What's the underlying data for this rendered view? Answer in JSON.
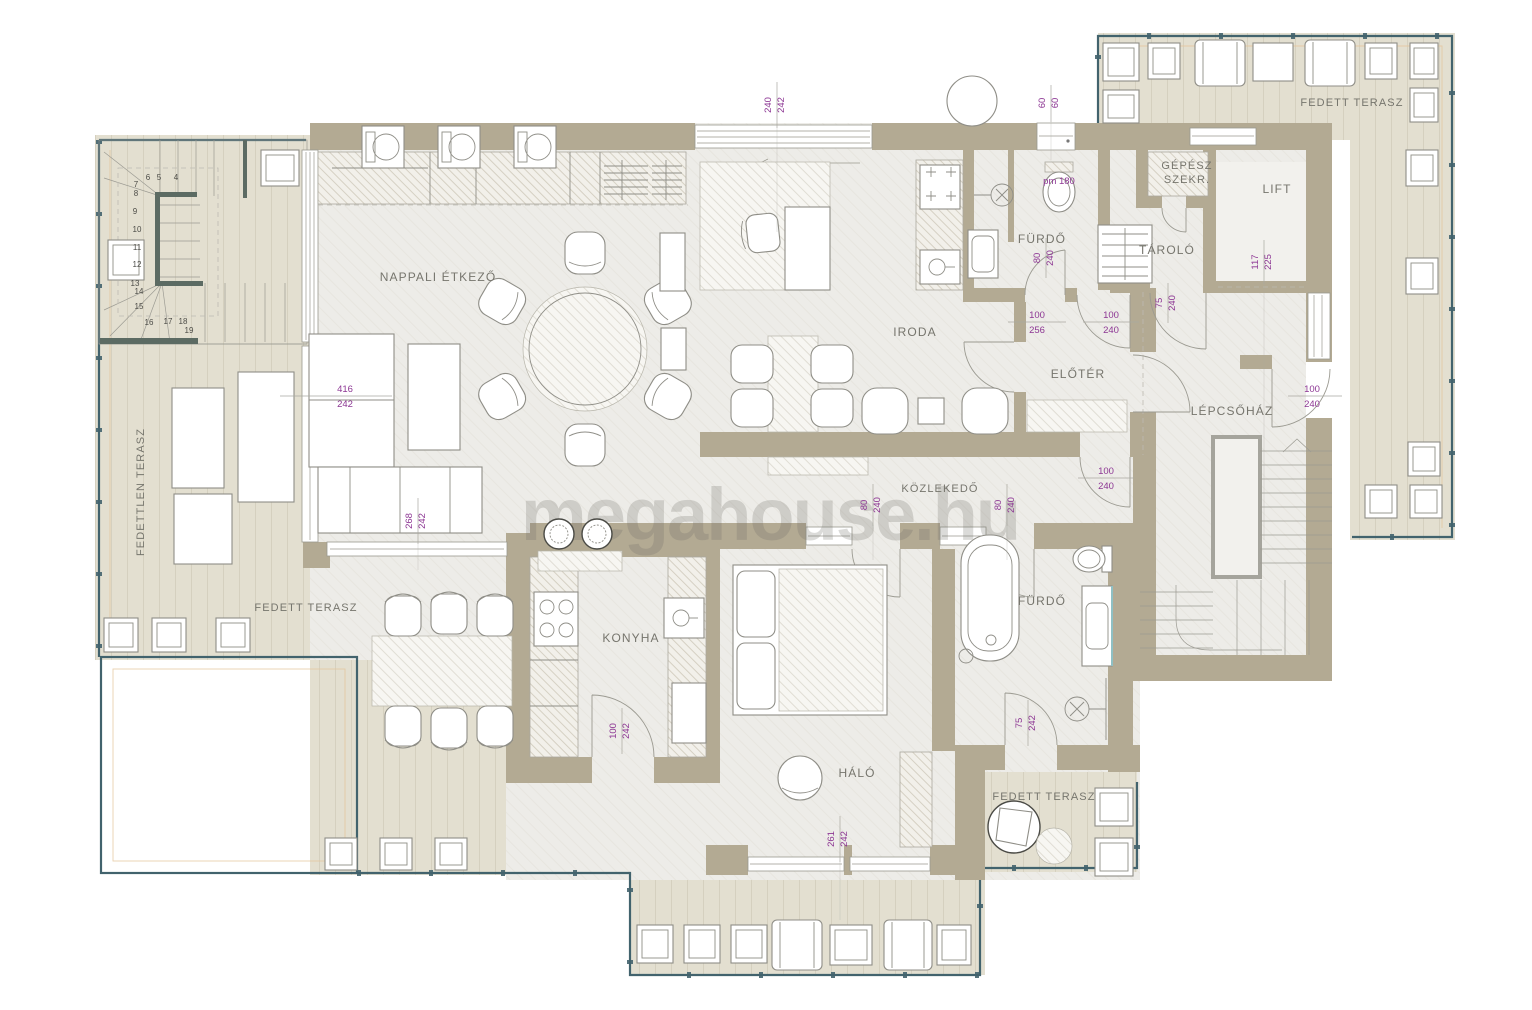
{
  "watermark": "megahouse.hu",
  "rooms": {
    "living": "NAPPALI ÉTKEZŐ",
    "office": "IRODA",
    "bath_top": "FÜRDŐ",
    "storage": "TÁROLÓ",
    "mech_line1": "GÉPÉSZ",
    "mech_line2": "SZEKR.",
    "lift": "LIFT",
    "foyer": "ELŐTÉR",
    "stairwell": "LÉPCSŐHÁZ",
    "corridor": "KÖZLEKEDŐ",
    "kitchen": "KONYHA",
    "bedroom": "HÁLÓ",
    "bath_bottom": "FÜRDŐ",
    "terrace_top_right": "FEDETT TERASZ",
    "terrace_bottom_left": "FEDETT TERASZ",
    "terrace_bottom_right": "FEDETT TERASZ",
    "terrace_left": "FEDETTLEN TERASZ"
  },
  "dims": {
    "top_window": {
      "a": "240",
      "b": "242"
    },
    "top_door": {
      "a": "60",
      "b": "60"
    },
    "wc_label": "pm 180",
    "bath_top_door": {
      "a": "80",
      "b": "240"
    },
    "foyer_left_door": {
      "a": "100",
      "b": "256"
    },
    "foyer_top_door": {
      "a": "100",
      "b": "240"
    },
    "storage_door": {
      "a": "75",
      "b": "240"
    },
    "lift_shaft": {
      "a": "117",
      "b": "225"
    },
    "stair_terrace_door": {
      "a": "100",
      "b": "240"
    },
    "living_window": {
      "a": "416",
      "b": "242"
    },
    "living_door": {
      "a": "268",
      "b": "242"
    },
    "corridor_door_a": {
      "a": "80",
      "b": "240"
    },
    "corridor_door_b": {
      "a": "80",
      "b": "240"
    },
    "corridor_end_door": {
      "a": "100",
      "b": "240"
    },
    "kitchen_door": {
      "a": "100",
      "b": "242"
    },
    "bath_bottom_door": {
      "a": "75",
      "b": "242"
    },
    "bedroom_window": {
      "a": "261",
      "b": "242"
    }
  },
  "steps": [
    "4",
    "5",
    "6",
    "7",
    "8",
    "9",
    "10",
    "11",
    "12",
    "13",
    "14",
    "15",
    "16",
    "17",
    "18",
    "19"
  ],
  "colors": {
    "wall": "#b3aa93",
    "wood": "#e3dfd0",
    "floor": "#edece8",
    "label": "#76756d",
    "dim": "#8d3794",
    "dimline": "#a9a8a0",
    "railing": "#42636d",
    "accent": "#e4c49b",
    "watermark_ink": "#6e6c66"
  }
}
